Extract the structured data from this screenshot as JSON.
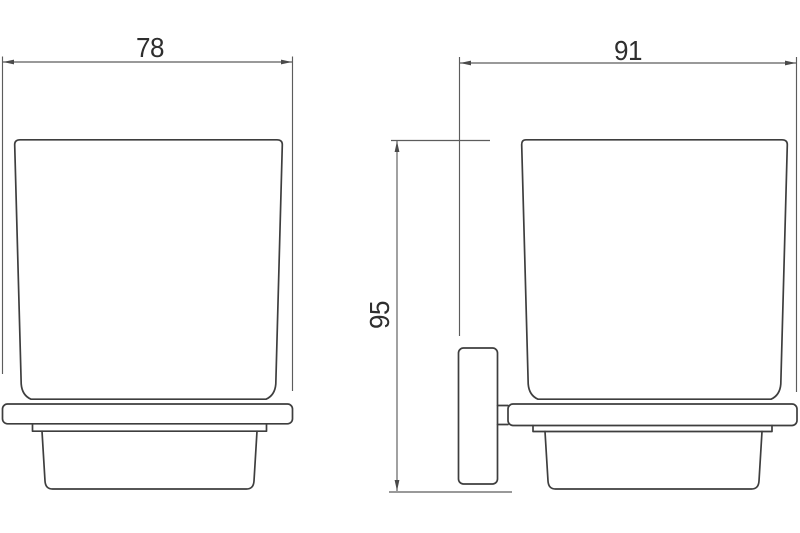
{
  "drawing": {
    "kind": "technical-dimension-drawing",
    "views": {
      "front": {
        "label": "front-view-of-tumbler-and-holder"
      },
      "side": {
        "label": "side-view-of-tumbler-with-wall-bracket"
      }
    },
    "dimensions": {
      "front_width": "78",
      "side_depth": "91",
      "height": "95"
    },
    "colors": {
      "outline": "#3e3e3e",
      "dimension_lines": "#5c5c5c",
      "text": "#2e2e2e",
      "background": "#ffffff"
    }
  }
}
